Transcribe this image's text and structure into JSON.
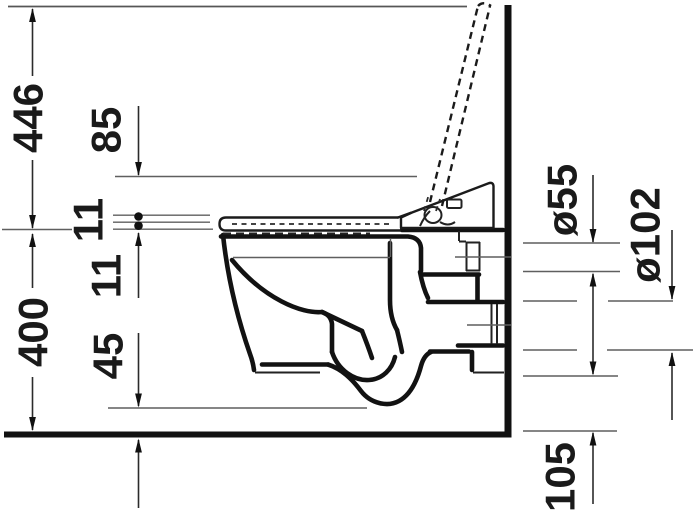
{
  "drawing": {
    "title": "wall-hung shower-toilet side elevation with connection dimensions",
    "dimensions": {
      "height_lid_open": "446",
      "unit_above_seat": "85",
      "lid_thickness": "11",
      "seat_thickness": "11",
      "rim_height": "400",
      "bottom_front_clearance": "45",
      "flush_pipe_diameter": "ø55",
      "drain_pipe_diameter": "ø102",
      "drain_bottom_height": "105"
    },
    "colors": {
      "line": "#1a1a1a",
      "background": "#ffffff"
    }
  }
}
